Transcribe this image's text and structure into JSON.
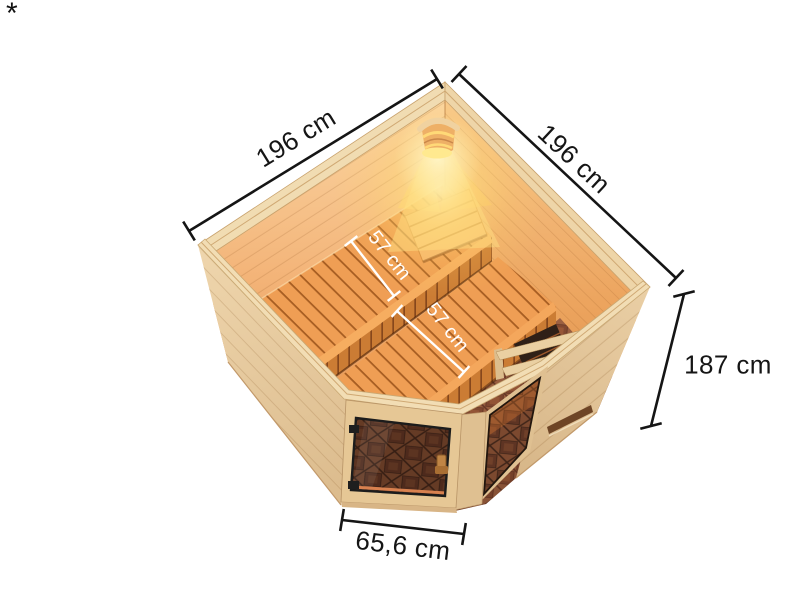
{
  "illustration": {
    "name": "corner-sauna-dimension-render",
    "description": "Isometric top cutaway render of a corner sauna: two bench levels along the back wall, corner lamp with warm glow, heater with wooden guard rail, diamond-pattern tiled floor, corner glass door with wooden knob and a fixed glass corner element",
    "colors": {
      "background": "#ffffff",
      "dimension_line": "#151515",
      "dimension_label_text": "#151515",
      "bench_dimension_label_text": "#ffffff",
      "exterior_wood": "#e7cba0",
      "interior_wood_lit": "#f2ae62",
      "bench_wood": "#ef9e54",
      "floor_tile": "#aa6b4a",
      "lamp_glow": "#ffd98c",
      "door_glass_tint": "#5a3322",
      "hinge_black": "#1f1f1f"
    }
  },
  "annotations": {
    "footnote_marker": "*",
    "dimensions": {
      "left_wall_width": {
        "label": "196 cm",
        "value_cm": 196
      },
      "right_wall_width": {
        "label": "196 cm",
        "value_cm": 196
      },
      "wall_height": {
        "label": "187 cm",
        "value_cm": 187
      },
      "upper_bench_depth": {
        "label": "57 cm",
        "value_cm": 57
      },
      "lower_bench_depth": {
        "label": "57 cm",
        "value_cm": 57
      },
      "door_width": {
        "label": "65,6 cm",
        "value_cm": 65.6
      }
    }
  }
}
